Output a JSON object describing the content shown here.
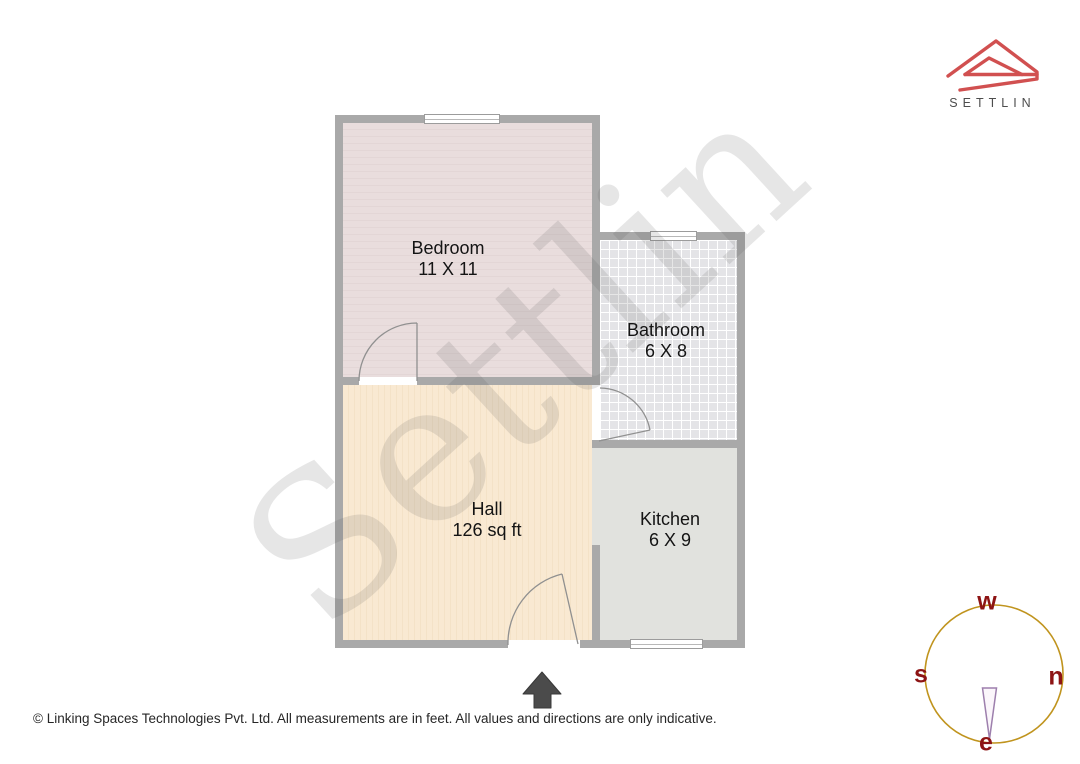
{
  "branding": {
    "logo_text": "SETTLIN",
    "watermark_text": "Settlin",
    "logo_mark_color": "#d15050",
    "logo_text_color": "#4d4d4d"
  },
  "plan": {
    "rooms": [
      {
        "id": "bedroom",
        "name": "Bedroom",
        "size": "11 X 11",
        "fill": "#e8dcdc"
      },
      {
        "id": "bathroom",
        "name": "Bathroom",
        "size": "6 X 8",
        "fill": "#e4e4e7"
      },
      {
        "id": "hall",
        "name": "Hall",
        "size": "126 sq ft",
        "fill": "#f9e9d2"
      },
      {
        "id": "kitchen",
        "name": "Kitchen",
        "size": "6 X 9",
        "fill": "#e1e2de"
      }
    ],
    "wall_color": "#a9a9a9",
    "door_arc_color": "#909090"
  },
  "icons": {
    "entrance_arrow": "up-arrow",
    "logo_mark": "roof-outline",
    "compass": "circle-with-needle"
  },
  "compass": {
    "labels": {
      "top": "w",
      "left": "s",
      "right": "n",
      "bottom": "e"
    },
    "circle_color": "#c0941e",
    "label_color": "#8d1414",
    "needle_color": "#9d7fad"
  },
  "footer": {
    "text": "© Linking Spaces Technologies Pvt. Ltd. All measurements are in feet. All values and directions are only indicative."
  }
}
